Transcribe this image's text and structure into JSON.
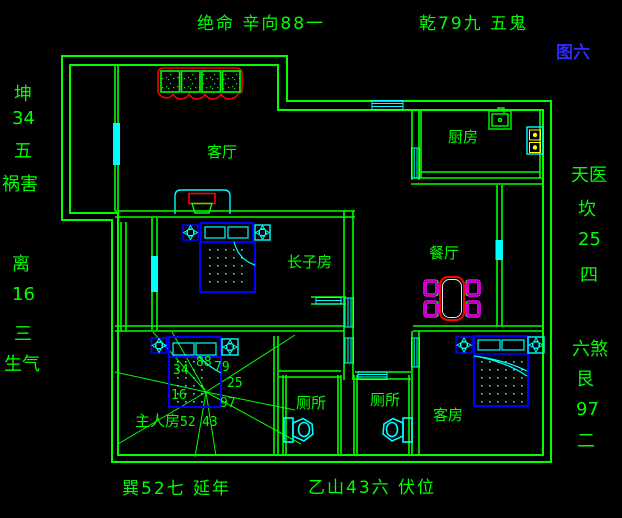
{
  "palette": {
    "line_green": "#00ff00",
    "cyan": "#00ffff",
    "red": "#ff0000",
    "magenta": "#ff00ff",
    "blue": "#0000ff",
    "yellow": "#ffff00",
    "figure_label_blue": "#2a2aff",
    "table_inner_white": "#e8e8e8",
    "background": "#000000"
  },
  "perimeter": {
    "top_left": "绝命 辛向88一",
    "top_right": "乾79九 五鬼",
    "figure_no": "图六",
    "left_upper": {
      "l1": "坤",
      "l2": "34",
      "l3": "五",
      "l4": "祸害"
    },
    "left_lower": {
      "l1": "离",
      "l2": "16",
      "l3": "三",
      "l4": "生气"
    },
    "right_upper": {
      "l1": "天医",
      "l2": "坎",
      "l3": "25",
      "l4": "四"
    },
    "right_lower": {
      "l1": "六煞",
      "l2": "艮",
      "l3": "97",
      "l4": "二"
    },
    "bottom_left": "巽52七 延年",
    "bottom_right": "乙山43六 伏位"
  },
  "rooms": {
    "living": "客厅",
    "kitchen": "厨房",
    "dining": "餐厅",
    "eldest_son": "长子房",
    "master": "主人房",
    "toilet_left": "厕所",
    "toilet_right": "厕所",
    "guest": "客房"
  },
  "compass": {
    "nw": "34",
    "n": "88",
    "ne": "79",
    "e": "25",
    "se": "97",
    "s": "43",
    "sw": "52",
    "w": "16"
  }
}
